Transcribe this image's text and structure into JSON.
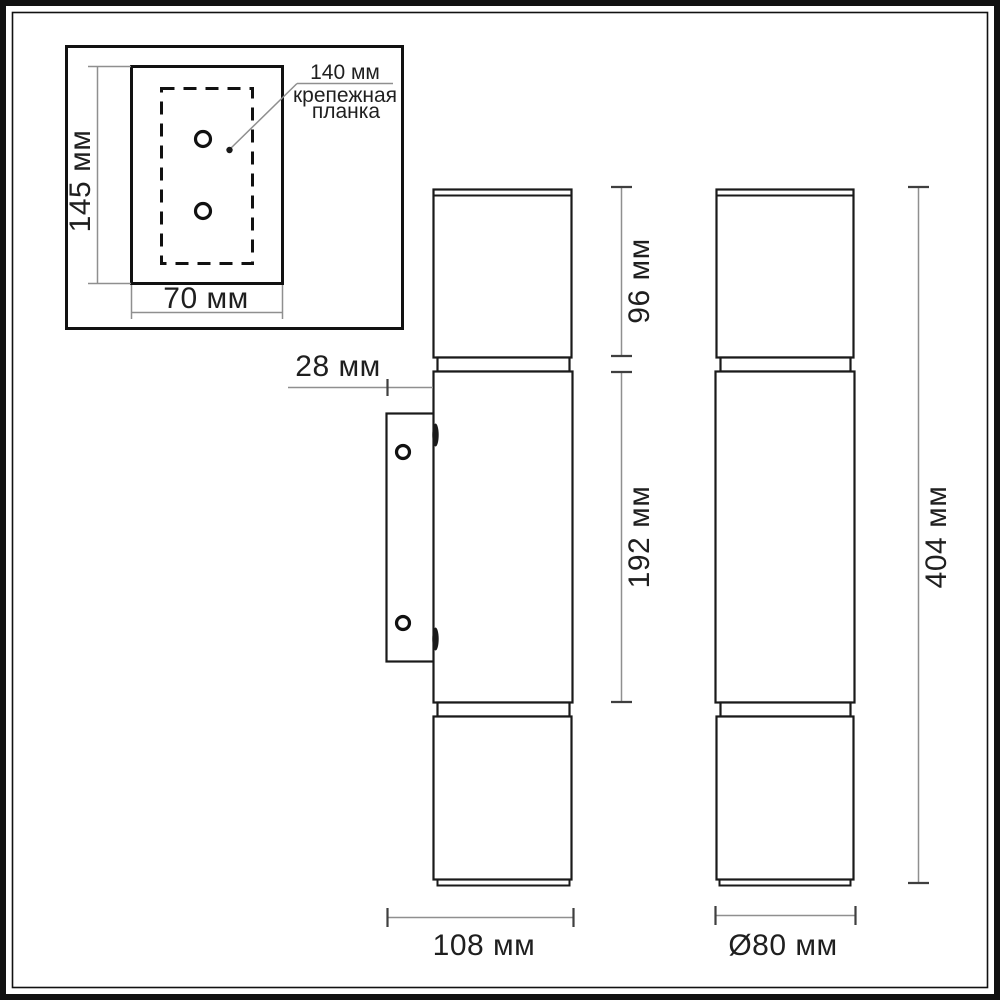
{
  "units_note": "мм",
  "inset": {
    "height_label": "145 мм",
    "width_label": "70 мм",
    "callout": {
      "line1": "140 мм",
      "line2": "крепежная",
      "line3": "планка"
    }
  },
  "side_view": {
    "wall_offset_label": "28 мм",
    "top_section_label": "96 мм",
    "middle_section_label": "192 мм",
    "depth_label": "108 мм"
  },
  "front_view": {
    "total_height_label": "404 мм",
    "diameter_label": "Ø80 мм"
  },
  "colors": {
    "outline": "#1a1a1a",
    "dimension_line": "#8f8f8f",
    "tick": "#3f3f3f",
    "background": "#ffffff"
  }
}
